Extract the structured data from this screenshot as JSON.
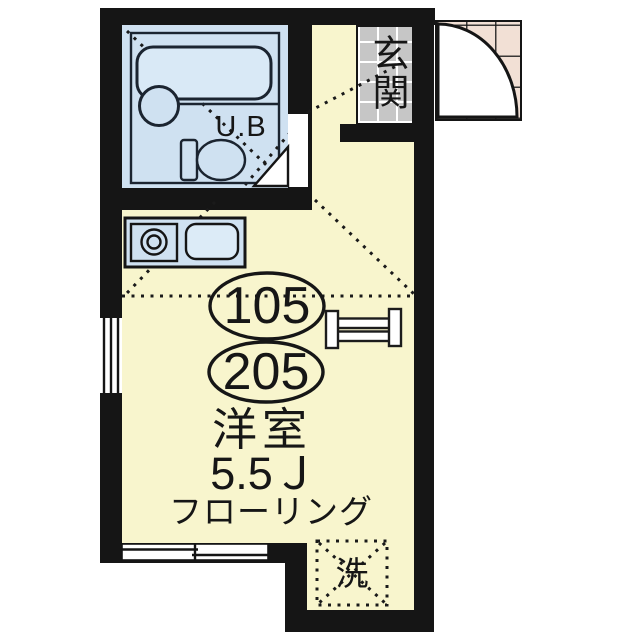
{
  "floorplan": {
    "unit_bath_label": "U.B",
    "entrance_label": "玄関",
    "unit_numbers": [
      "105",
      "205"
    ],
    "room_type": "洋室",
    "room_size": "5.5Ｊ",
    "flooring_label": "フローリング",
    "laundry_label": "洗",
    "colors": {
      "wall": "#151515",
      "room_fill": "#f8f5cd",
      "wet_area_fill": "#cfe1f1",
      "entrance_tile": "#c6c6c6",
      "porch_tile": "#f2e0d5",
      "line": "#161616"
    }
  }
}
